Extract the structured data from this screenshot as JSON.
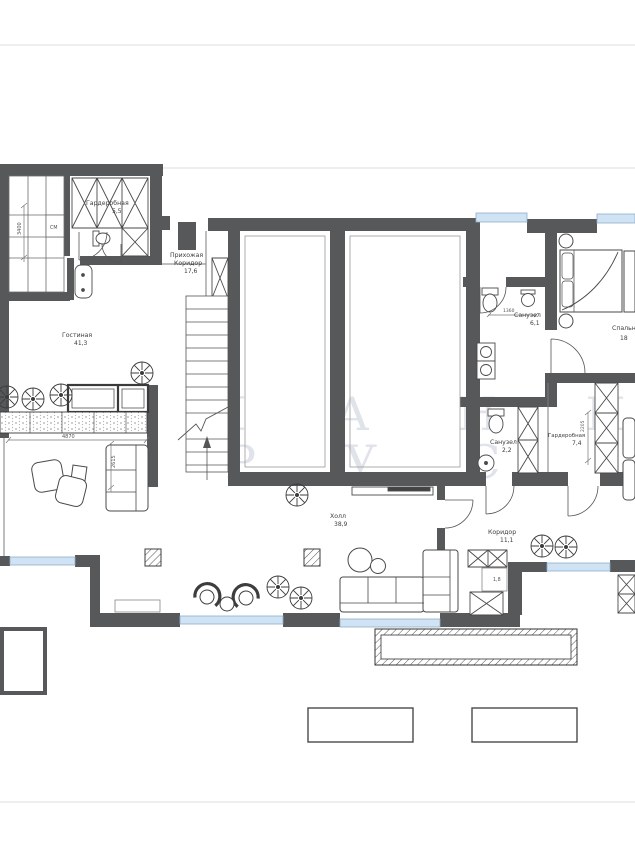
{
  "watermark": {
    "line1": "ПЛАНИ",
    "line2": "РУС"
  },
  "rooms": {
    "wardrobe_top": {
      "name": "Гардеробная",
      "area": "5,5"
    },
    "hallway_entry": {
      "name": "Прихожая",
      "name2": "Коридор",
      "area": "17,6"
    },
    "living": {
      "name": "Гостиная",
      "area": "41,3"
    },
    "bedroom": {
      "name": "Спальня",
      "area": "18"
    },
    "bath_main": {
      "name": "Санузел",
      "area": "6,1"
    },
    "bath_small": {
      "name": "Санузел",
      "area": "2,2"
    },
    "wardrobe_right": {
      "name": "Гардеробная",
      "area": "7,4"
    },
    "hall": {
      "name": "Холл",
      "area": "38,9"
    },
    "corridor": {
      "name": "Коридор",
      "area": "11,1"
    },
    "storage": {
      "area": "1,8"
    }
  },
  "appliances": {
    "washing_machine": "СМ"
  },
  "dimensions": {
    "closet_side": "3400",
    "kitchen_run": "4870",
    "sofa_run": "2615",
    "bath_width": "1360",
    "wardrobe_depth": "2205"
  },
  "colors": {
    "wall": "#57585a",
    "window": "#cfe3f5",
    "line": "#4a4a4a"
  }
}
